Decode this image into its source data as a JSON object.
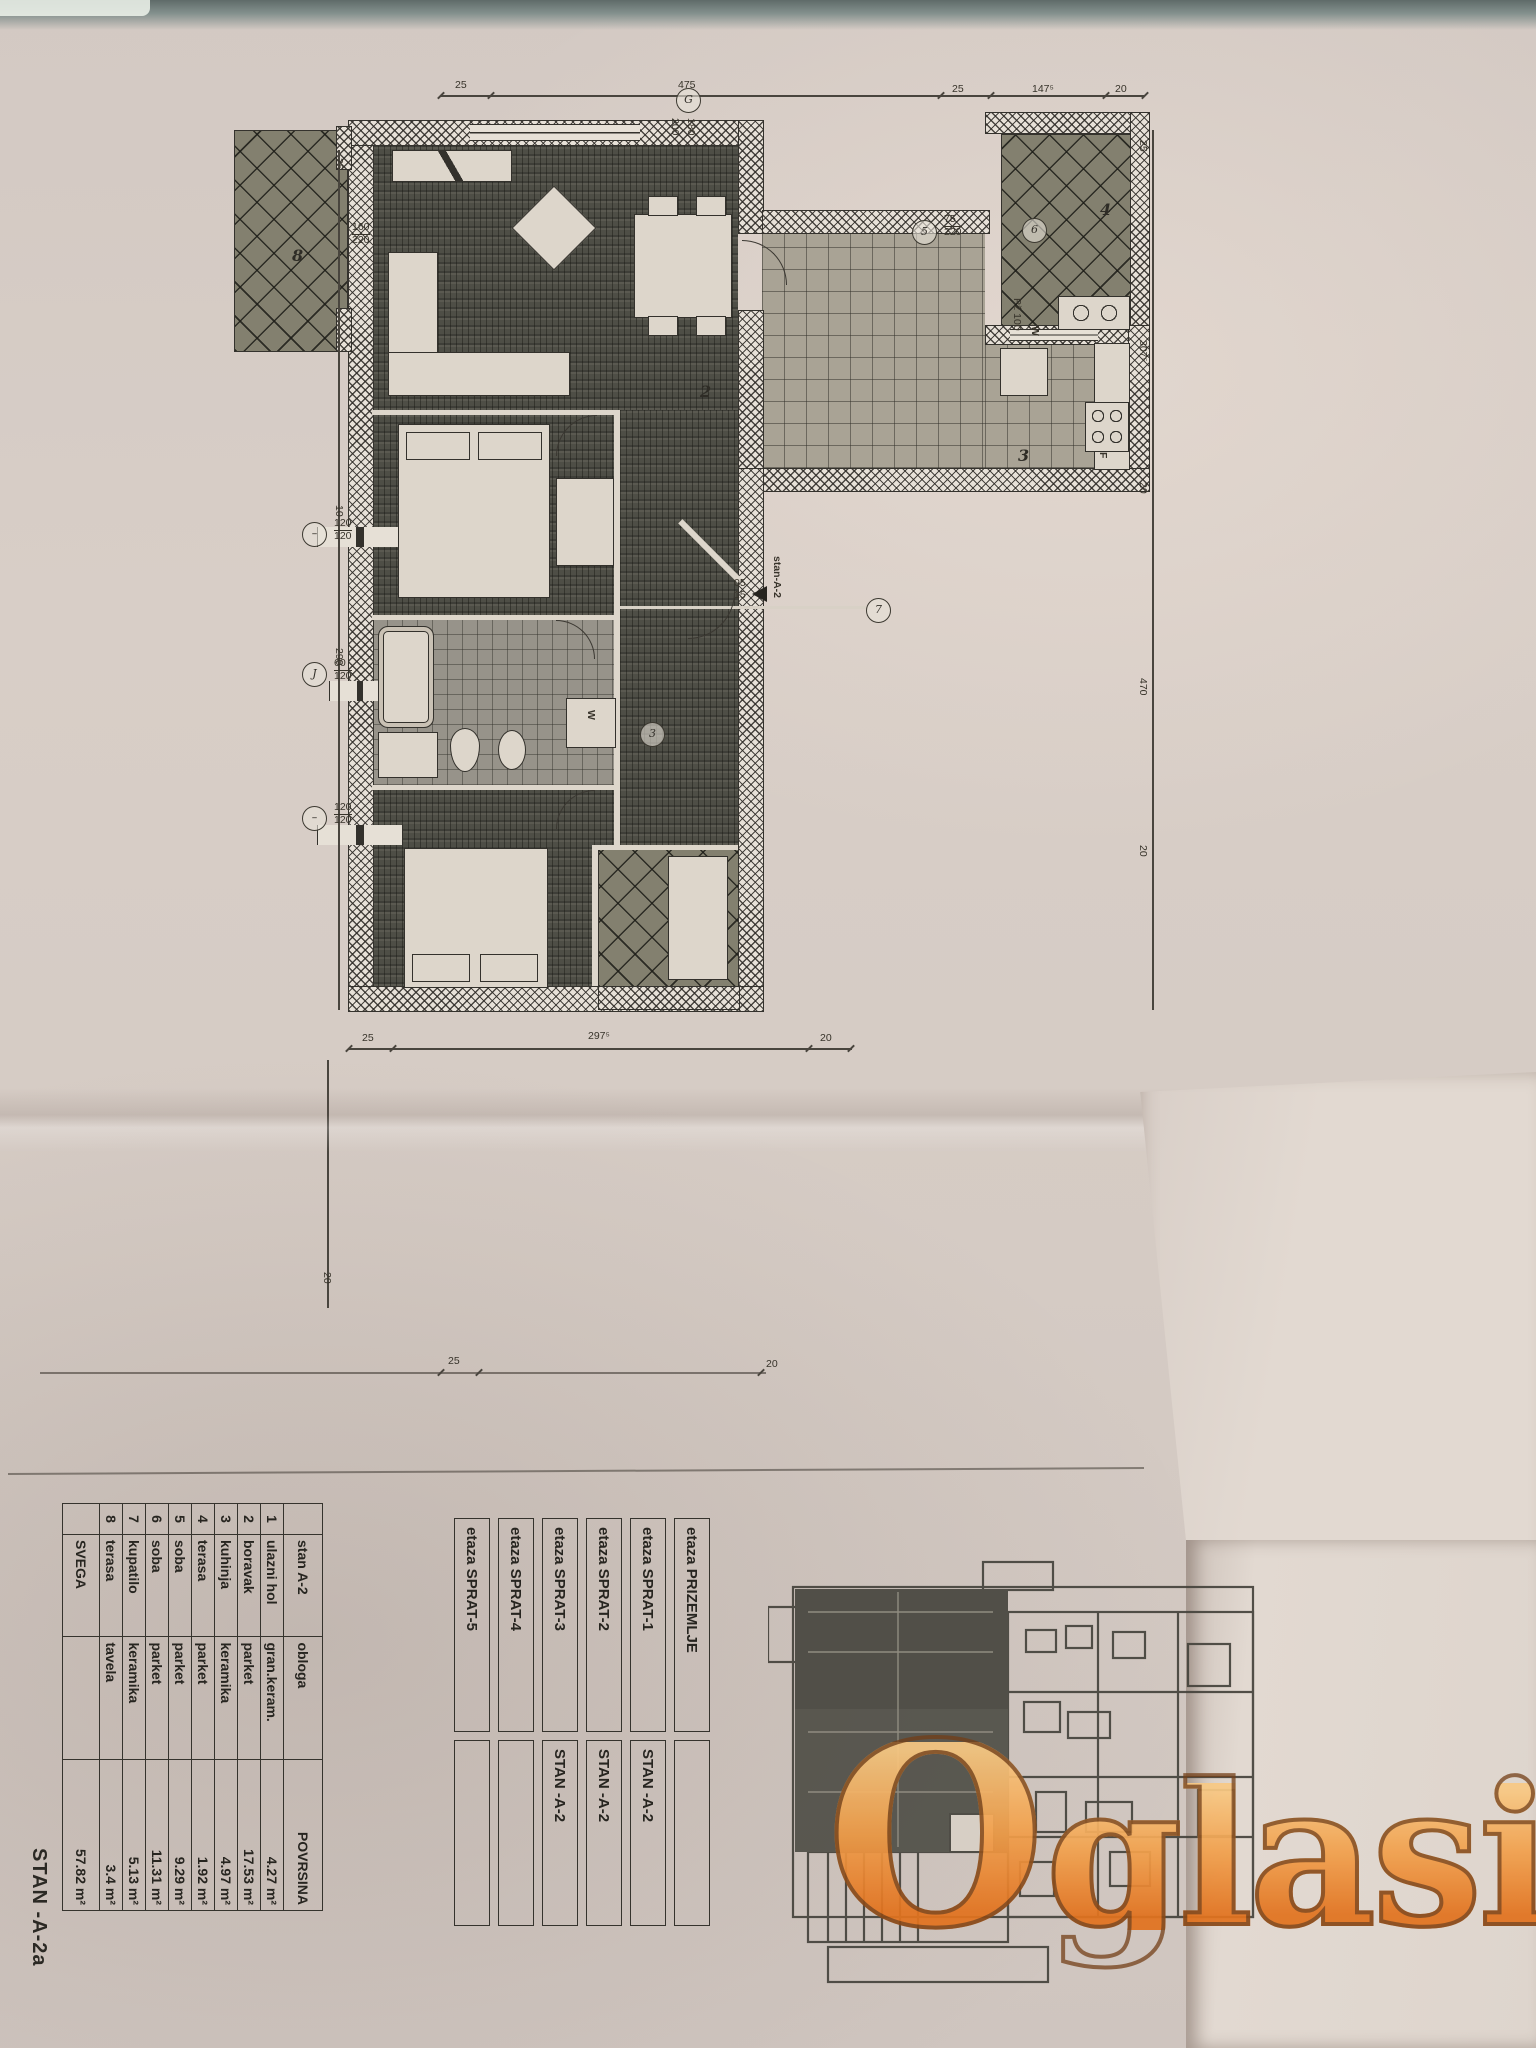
{
  "plan": {
    "dims_top": [
      "25",
      "475",
      "25",
      "147⁵",
      "20"
    ],
    "dims_bottom": [
      "25",
      "297⁵",
      "20"
    ],
    "dims_lower": [
      "25",
      "20"
    ],
    "dims_left": [
      "25",
      "10",
      "290"
    ],
    "dims_left_lower": [
      "20"
    ],
    "dims_right": [
      "25",
      "307⁵",
      "20",
      "470",
      "20"
    ],
    "marks": {
      "top_window": {
        "sym": "G",
        "a": "200",
        "b": "180"
      },
      "terrace8_win": {
        "a": "160",
        "b": "220"
      },
      "kitchen_door": {
        "sym": "5",
        "a": "75",
        "b": "220"
      },
      "terrace4": {
        "sym": "6"
      },
      "left_win1": {
        "sym": "–",
        "a": "120",
        "b": "120"
      },
      "left_win2": {
        "sym": "J",
        "a": "60",
        "b": "120"
      },
      "left_win3": {
        "sym": "–",
        "a": "120",
        "b": "120"
      },
      "corridor": {
        "sym": "7"
      },
      "bath": {
        "sym": "3"
      }
    },
    "rooms": {
      "living": "2",
      "kitchen": "3",
      "terrace4": "4",
      "terrace8": "8"
    },
    "labels": {
      "fridge": "F",
      "washer": "W",
      "kitchen_note": "Pž 100",
      "kitchen_w": "W",
      "entry_name": "stan-A-2",
      "entry_a": "05",
      "entry_b": "15"
    }
  },
  "schedule": {
    "header": {
      "c1": "stan A-2",
      "c2": "obloga",
      "c3": "POVRSINA"
    },
    "rows": [
      {
        "n": "1",
        "name": "ulazni hol",
        "finish": "gran.keram.",
        "area": "4.27 m²"
      },
      {
        "n": "2",
        "name": "boravak",
        "finish": "parket",
        "area": "17.53 m²"
      },
      {
        "n": "3",
        "name": "kuhinja",
        "finish": "keramika",
        "area": "4.97 m²"
      },
      {
        "n": "4",
        "name": "terasa",
        "finish": "parket",
        "area": "1.92 m²"
      },
      {
        "n": "5",
        "name": "soba",
        "finish": "parket",
        "area": "9.29 m²"
      },
      {
        "n": "6",
        "name": "soba",
        "finish": "parket",
        "area": "11.31 m²"
      },
      {
        "n": "7",
        "name": "kupatilo",
        "finish": "keramika",
        "area": "5.13 m²"
      },
      {
        "n": "8",
        "name": "terasa",
        "finish": "tavela",
        "area": "3.4 m²"
      }
    ],
    "footer": {
      "label": "SVEGA",
      "area": "57.82 m²"
    }
  },
  "floors": {
    "rows": [
      {
        "etaza": "etaza PRIZEMLJE",
        "stan": ""
      },
      {
        "etaza": "etaza SPRAT-1",
        "stan": "STAN -A-2"
      },
      {
        "etaza": "etaza SPRAT-2",
        "stan": "STAN -A-2"
      },
      {
        "etaza": "etaza SPRAT-3",
        "stan": "STAN -A-2"
      },
      {
        "etaza": "etaza SPRAT-4",
        "stan": ""
      },
      {
        "etaza": "etaza SPRAT-5",
        "stan": ""
      }
    ]
  },
  "stamp": "STAN -A-2a",
  "watermark": {
    "main": "O",
    "rest": "glasi",
    "suffix": ".rs"
  },
  "colors": {
    "accent_orange": "#ef9b40",
    "paper": "#d7cdc6",
    "ink": "#35332d"
  }
}
